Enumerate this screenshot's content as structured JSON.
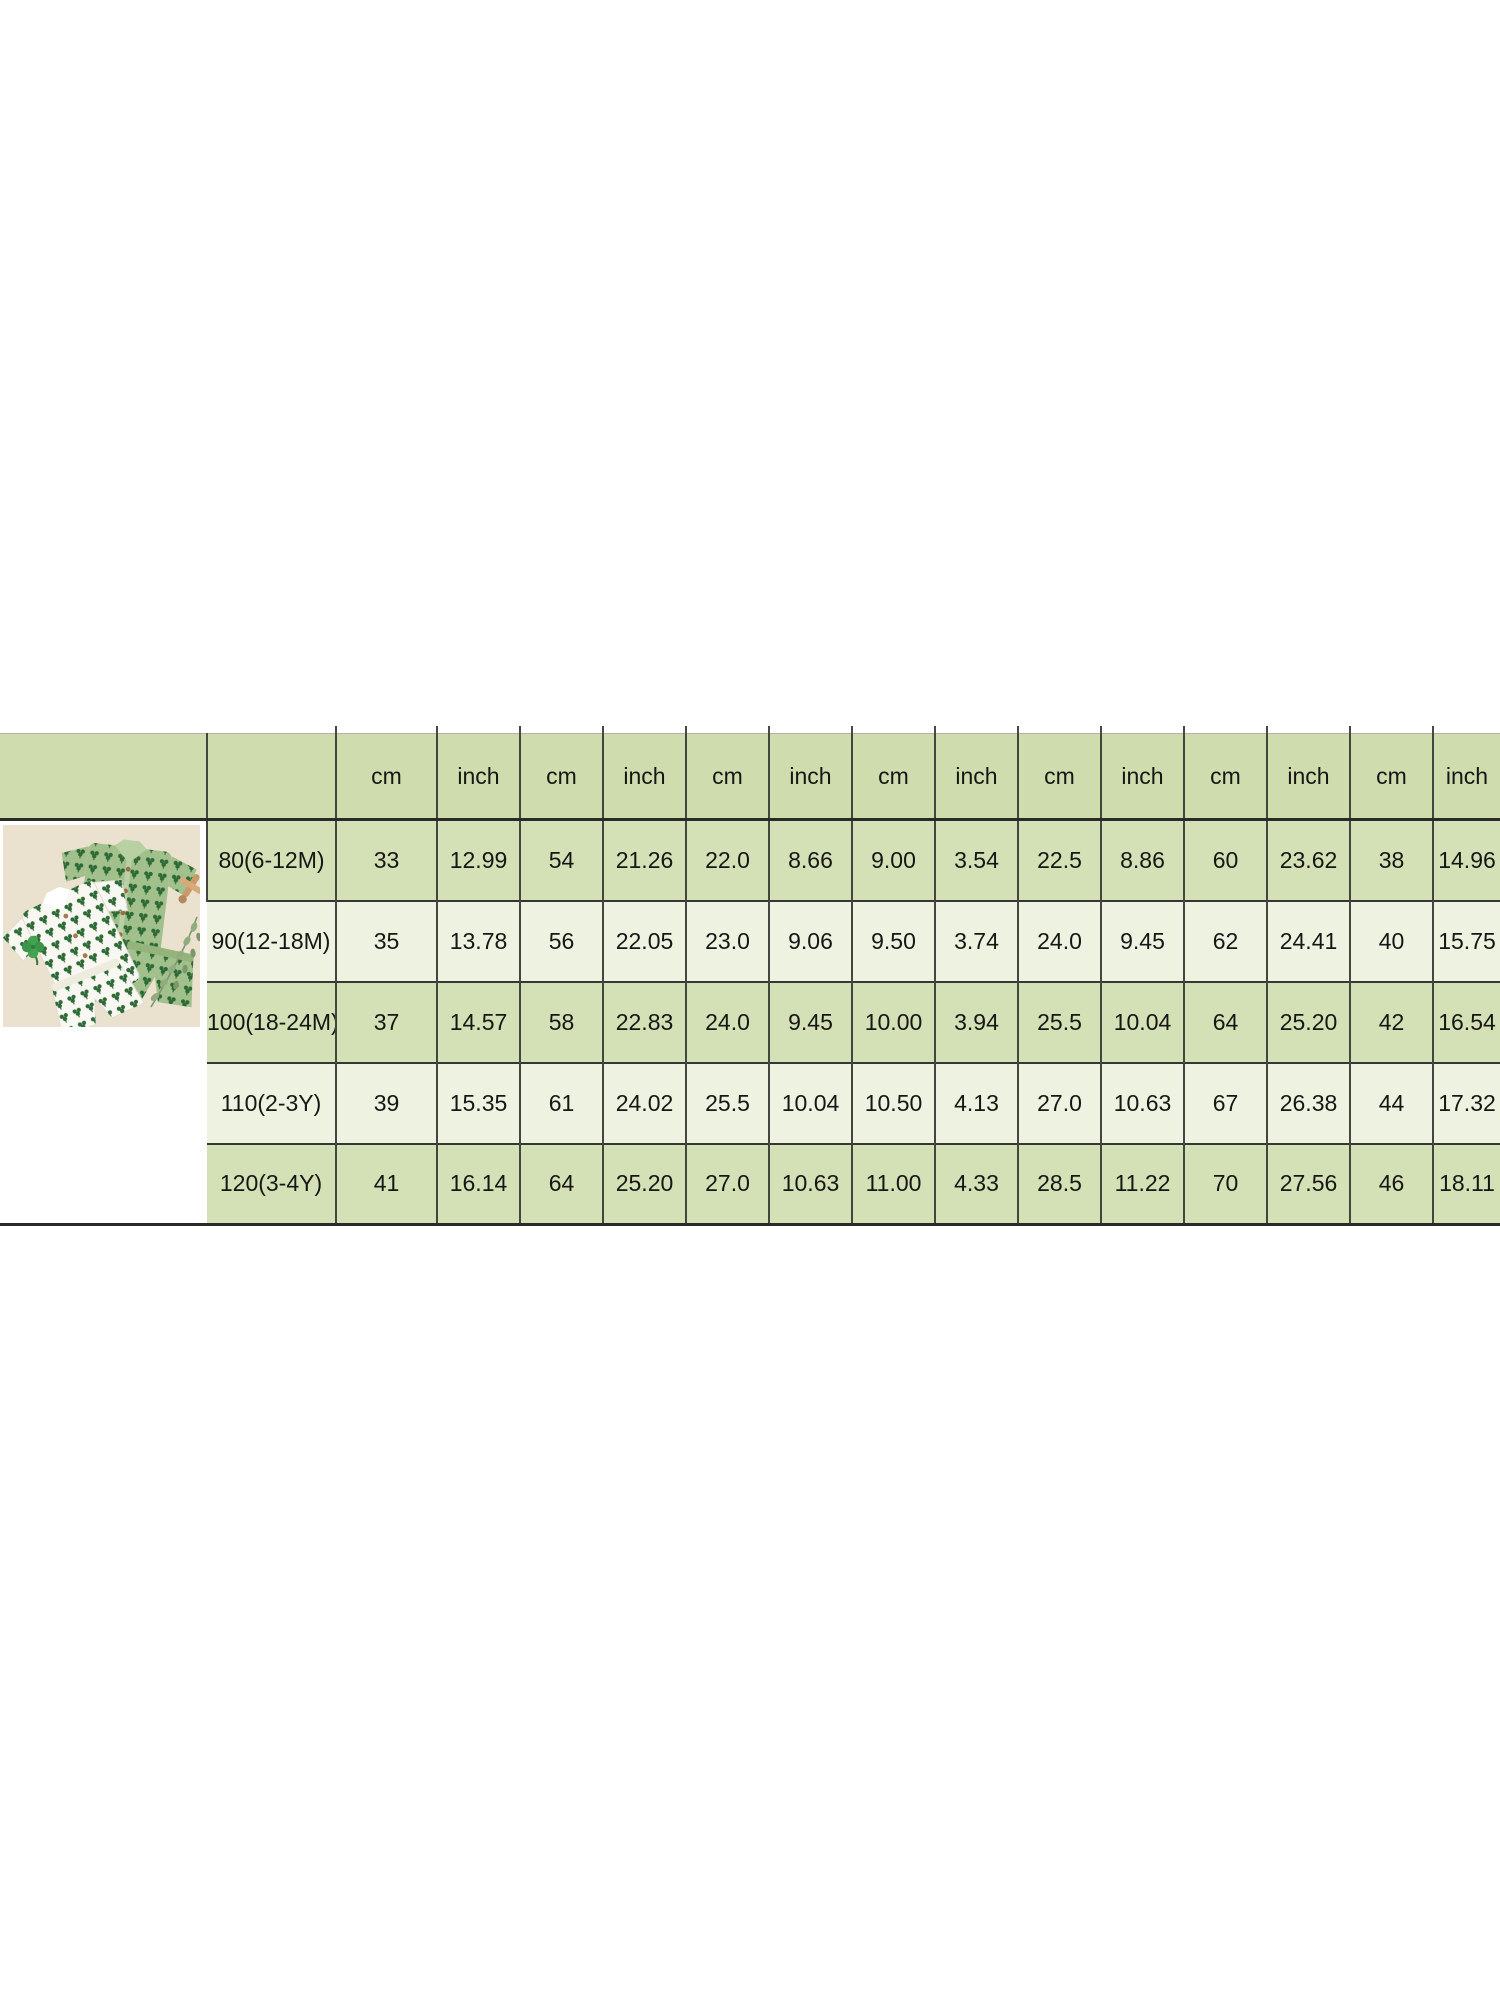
{
  "page": {
    "background": "#ffffff"
  },
  "chart_data": {
    "type": "table",
    "title": "",
    "corner_header": "",
    "size_column_header": "",
    "unit_header": [
      "cm",
      "inch",
      "cm",
      "inch",
      "cm",
      "inch",
      "cm",
      "inch",
      "cm",
      "inch",
      "cm",
      "inch",
      "cm",
      "inch"
    ],
    "measurement_pairs": 7,
    "rows": [
      {
        "size": "80(6-12M)",
        "values": [
          "33",
          "12.99",
          "54",
          "21.26",
          "22.0",
          "8.66",
          "9.00",
          "3.54",
          "22.5",
          "8.86",
          "60",
          "23.62",
          "38",
          "14.96"
        ]
      },
      {
        "size": "90(12-18M)",
        "values": [
          "35",
          "13.78",
          "56",
          "22.05",
          "23.0",
          "9.06",
          "9.50",
          "3.74",
          "24.0",
          "9.45",
          "62",
          "24.41",
          "40",
          "15.75"
        ]
      },
      {
        "size": "100(18-24M)",
        "values": [
          "37",
          "14.57",
          "58",
          "22.83",
          "24.0",
          "9.45",
          "10.00",
          "3.94",
          "25.5",
          "10.04",
          "64",
          "25.20",
          "42",
          "16.54"
        ]
      },
      {
        "size": "110(2-3Y)",
        "values": [
          "39",
          "15.35",
          "61",
          "24.02",
          "25.5",
          "10.04",
          "10.50",
          "4.13",
          "27.0",
          "10.63",
          "67",
          "26.38",
          "44",
          "17.32"
        ]
      },
      {
        "size": "120(3-4Y)",
        "values": [
          "41",
          "16.14",
          "64",
          "25.20",
          "27.0",
          "10.63",
          "11.00",
          "4.33",
          "28.5",
          "11.22",
          "70",
          "27.56",
          "46",
          "18.11"
        ]
      }
    ],
    "layout_hints": {
      "striping": [
        "green",
        "light",
        "green",
        "light",
        "green"
      ],
      "grid": true,
      "right_edge_cropped": true
    }
  },
  "colors": {
    "header_bg": "#cfddae",
    "row_green": "#d4e0b6",
    "row_light": "#eef2e1",
    "grid_line": "#3a3a38",
    "photo_background": "#eae2cf",
    "white_outfit": "#f8f7f2",
    "green_outfit": "#a2c08b",
    "print_green": "#2d6a35",
    "clover_green": "#42a351",
    "wooden_toy": "#c99a6a",
    "leaf_sprig": "#8aa478"
  },
  "product_photo": {
    "description": "Two toddler short-sleeve shirt and shorts sets with green clover print, one white and one sage green, laid flat on a beige background with a four-leaf clover, a small wooden toy and a eucalyptus sprig"
  }
}
